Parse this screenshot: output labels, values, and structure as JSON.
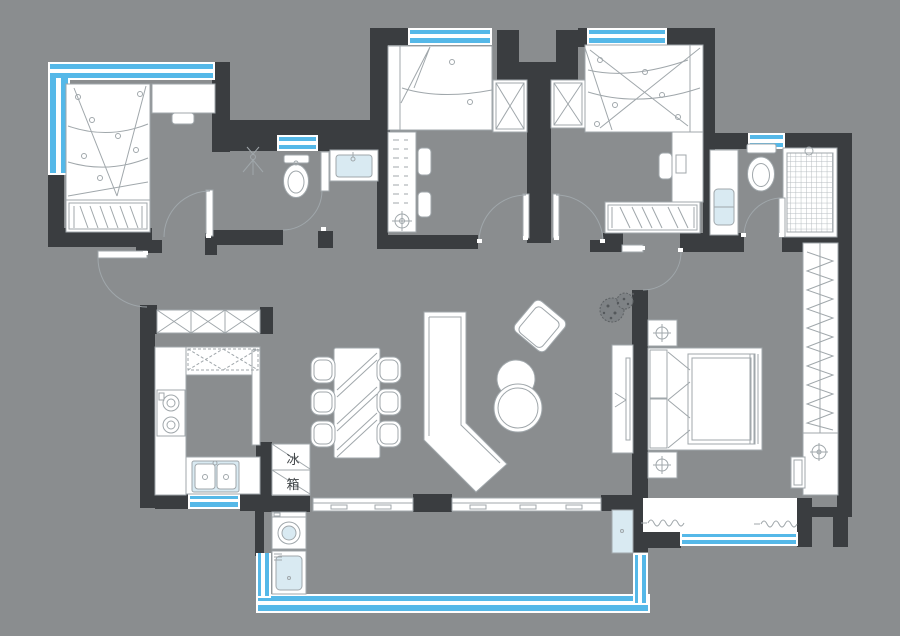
{
  "meta": {
    "type": "residential-floor-plan",
    "orientation": "top-down"
  },
  "labels": {
    "fridge_char_top": "冰",
    "fridge_char_bottom": "箱"
  },
  "colors": {
    "background": "#8a8d8f",
    "wall": "#3a3d40",
    "line": "#a0a7ab",
    "window-blue": "#55b8e8",
    "glass": "#d9eaf2",
    "label-text": "#3f4346"
  },
  "symbols": [
    "double-bed",
    "single-bed",
    "wardrobe-hangers",
    "wardrobe-crossed",
    "desk",
    "chair",
    "toilet",
    "washbasin",
    "shower-sprinkler",
    "shower-tile-floor",
    "bathtub-door-swing",
    "gas-stove",
    "kitchen-sink",
    "refrigerator",
    "shoe-cabinet",
    "dining-table",
    "dining-chair",
    "l-shaped-sofa",
    "coffee-table",
    "armchair",
    "tv-cabinet",
    "potted-plant",
    "bedside-lamp",
    "washing-machine",
    "mop-sink",
    "floor-drain",
    "drying-rack",
    "door-swing",
    "window-band",
    "sliding-door-track",
    "glass-panel",
    "curtain-squiggle"
  ]
}
